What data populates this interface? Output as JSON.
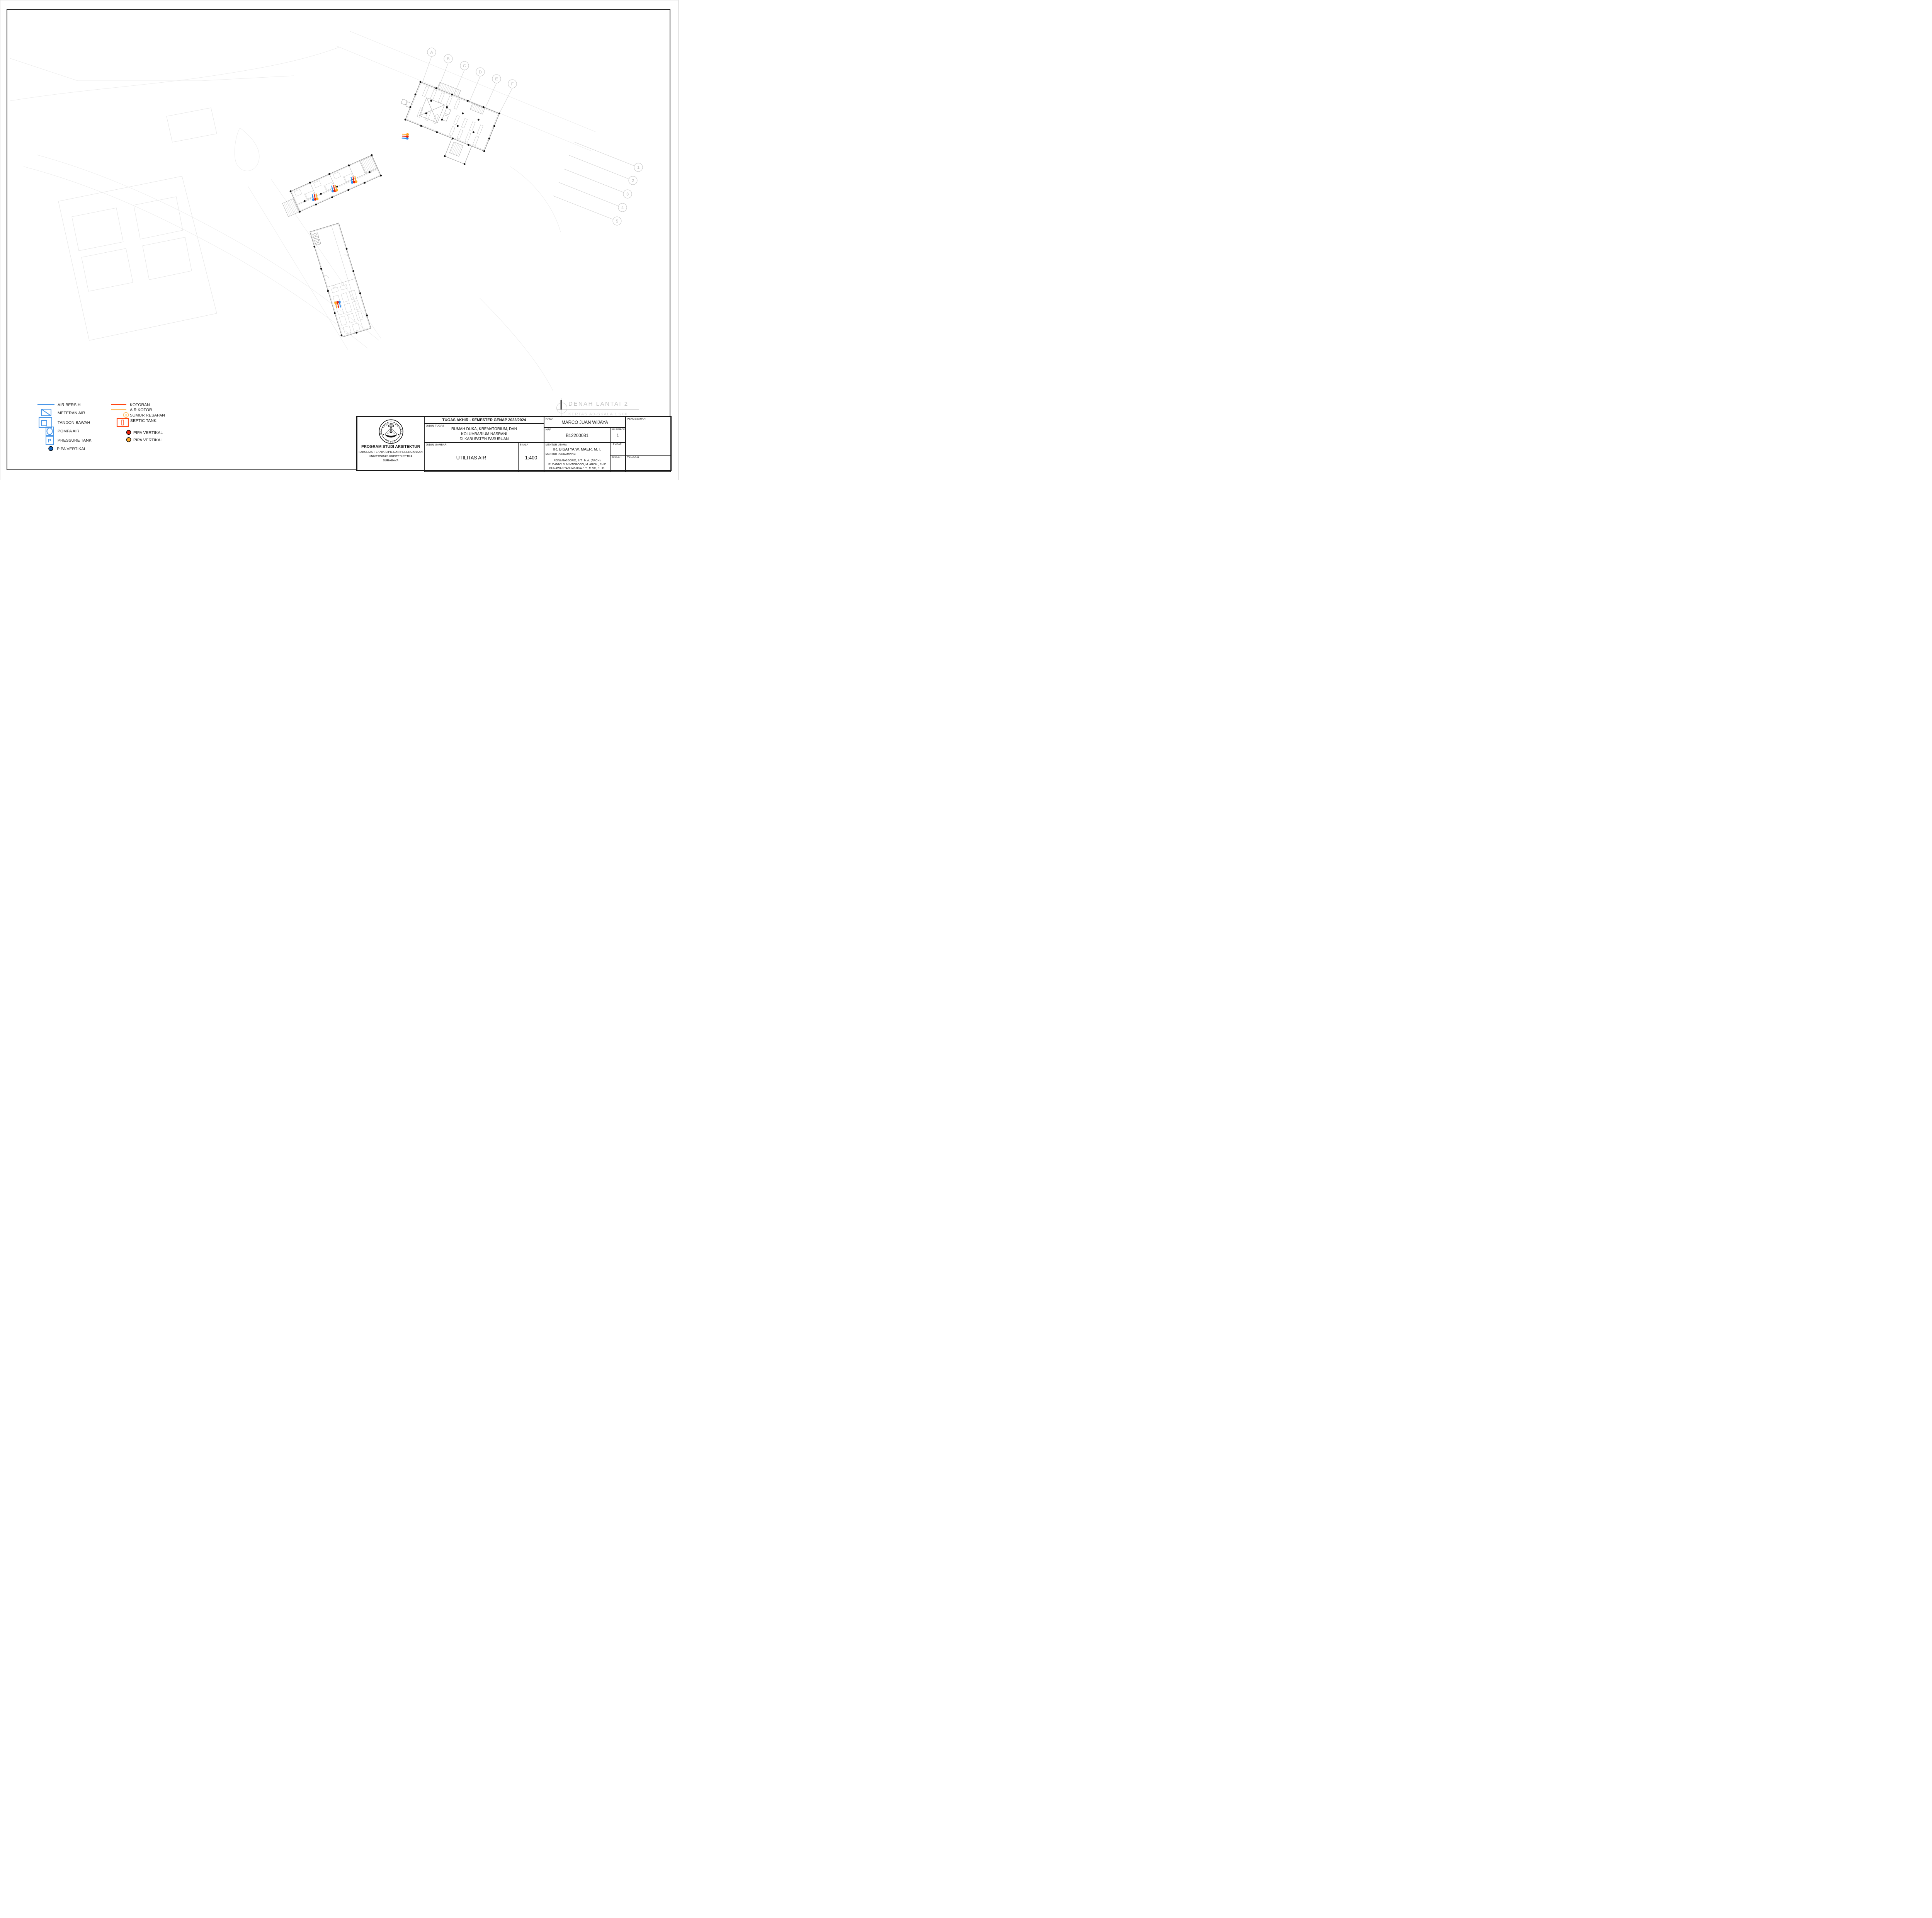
{
  "sheet": {
    "figure_title": "DENAH LANTAI 2",
    "figure_subtitle": "KERTAS A0-SKALA 1:200"
  },
  "colors": {
    "air_bersih": "#4a97e8",
    "pipa_vertikal_biru": "#1565c0",
    "kotoran": "#ff4613",
    "air_kotor": "#ffbf66",
    "sumur_resapan": "#ffbf66",
    "septic_tank": "#ff4613",
    "pipa_vertikal_merah": "#e8200a",
    "pipa_vertikal_kuning": "#ffaa2b",
    "riser_blue": "#2e8ef0",
    "riser_red": "#e8200a",
    "riser_orange": "#ffa726"
  },
  "legend": {
    "left": [
      {
        "label": "AIR BERSIH",
        "symbol": "line-blue"
      },
      {
        "label": "METERAN AIR",
        "symbol": "meter-box"
      },
      {
        "label": "TANDON BAWAH",
        "symbol": "nested-box"
      },
      {
        "label": "POMPA AIR",
        "symbol": "pump-box"
      },
      {
        "label": "PRESSURE TANK",
        "symbol": "p-box",
        "symbol_letter": "P"
      },
      {
        "label": "PIPA VERTIKAL",
        "symbol": "dot-blue"
      }
    ],
    "right": [
      {
        "label": "KOTORAN",
        "symbol": "line-red"
      },
      {
        "label": "AIR KOTOR",
        "symbol": "line-orange"
      },
      {
        "label": "SUMUR RESAPAN",
        "symbol": "circle-r",
        "symbol_letter": "R"
      },
      {
        "label": "SEPTIC TANK",
        "symbol": "septic-box"
      },
      {
        "label": "PIPA VERTIKAL",
        "symbol": "dot-red"
      },
      {
        "label": "PIPA VERTIKAL",
        "symbol": "dot-orange"
      }
    ]
  },
  "grid_bubbles": {
    "letters": [
      "A",
      "B",
      "C",
      "D",
      "E",
      "F"
    ],
    "numbers": [
      "1",
      "2",
      "3",
      "4",
      "5"
    ]
  },
  "title_block": {
    "header": "TUGAS AKHIR - SEMESTER GENAP 2023/2024",
    "labels": {
      "judul_tugas": "JUDUL TUGAS",
      "judul_gambar": "JUDUL GAMBAR",
      "skala": "SKALA",
      "nama": "NAMA",
      "nrp": "NRP",
      "kelompok": "KELOMPOK",
      "mentor_utama": "MENTOR UTAMA",
      "mentor_pendamping": "MENTOR PENDAMPING",
      "lembar": "LEMBAR",
      "jumlah": "JUMLAH",
      "tanggal": "TANGGAL",
      "pengesahan": "PENGESAHAN"
    },
    "judul_tugas_lines": [
      "RUMAH DUKA, KREMATORIUM, DAN",
      "KOLUMBARIUM NASRANI",
      "DI KABUPATEN PASURUAN"
    ],
    "judul_gambar": "UTILITAS AIR",
    "skala": "1:400",
    "nama": "MARCO JUAN WIJAYA",
    "nrp": "B12200081",
    "kelompok": "1",
    "mentor_utama": "IR. BISATYA W. MAER, M.T.",
    "mentor_pendamping_lines": [
      "RONI ANGGORO, S.T., M.A. (ARCH)",
      "IR. DANNY S. MINTOROGO, M. ARCH., PH.D",
      "GUNAWAN TANUWIJAYA S.T., M.SC, PH.D."
    ],
    "institution": {
      "program": "PROGRAM STUDI ARSITEKTUR",
      "fakultas": "FAKULTAS TEKNIK SIPIL DAN PERENCANAAN",
      "universitas": "UNIVERSITAS KRISTEN PETRA",
      "kota": "SURABAYA",
      "logo_text_top": "UNIVERSITAS KRISTEN",
      "logo_text_bottom": "PETRA"
    }
  }
}
